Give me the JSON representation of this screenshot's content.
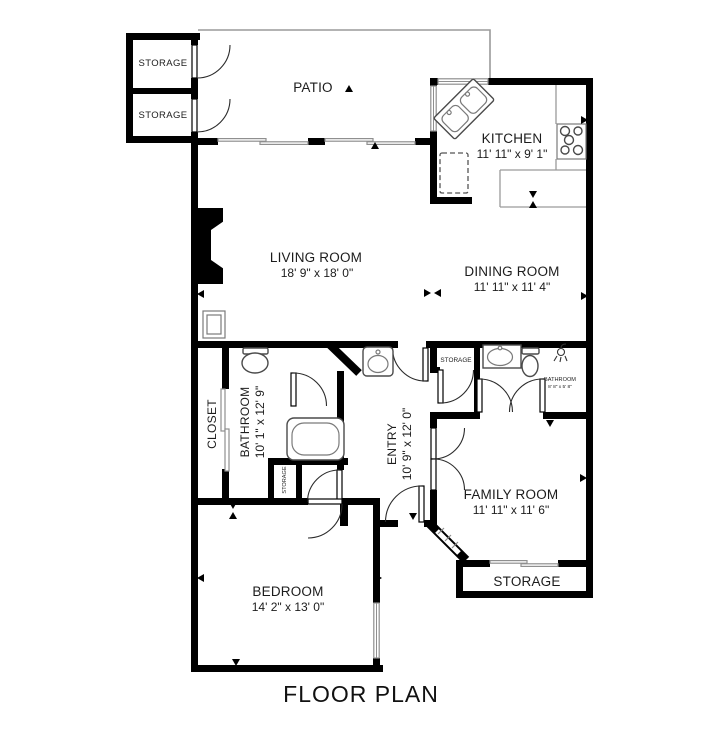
{
  "title": "FLOOR PLAN",
  "colors": {
    "wall": "#000000",
    "thin_line": "#9a9a9a",
    "text": "#1c1c1c",
    "background": "#ffffff"
  },
  "rooms": {
    "storage_top_upper": {
      "label": "STORAGE"
    },
    "storage_top_lower": {
      "label": "STORAGE"
    },
    "patio": {
      "label": "PATIO"
    },
    "kitchen": {
      "label": "KITCHEN",
      "dimensions": "11' 11\" x 9' 1\""
    },
    "living_room": {
      "label": "LIVING ROOM",
      "dimensions": "18' 9\" x 18' 0\""
    },
    "dining_room": {
      "label": "DINING ROOM",
      "dimensions": "11' 11\" x 11' 4\""
    },
    "closet": {
      "label": "CLOSET"
    },
    "bathroom_main": {
      "label": "BATHROOM",
      "dimensions": "10' 1\" x 12' 9\""
    },
    "entry": {
      "label": "ENTRY",
      "dimensions": "10' 9\" x 12' 0\""
    },
    "storage_hall": {
      "label": "STORAGE"
    },
    "bathroom_second": {
      "label": "BATHROOM",
      "dimensions": "8' 8\" x 5' 8\""
    },
    "storage_bath": {
      "label": "STORAGE"
    },
    "family_room": {
      "label": "FAMILY ROOM",
      "dimensions": "11' 11\" x 11' 6\""
    },
    "storage_family": {
      "label": "STORAGE"
    },
    "bedroom": {
      "label": "BEDROOM",
      "dimensions": "14' 2\" x 13' 0\""
    }
  }
}
